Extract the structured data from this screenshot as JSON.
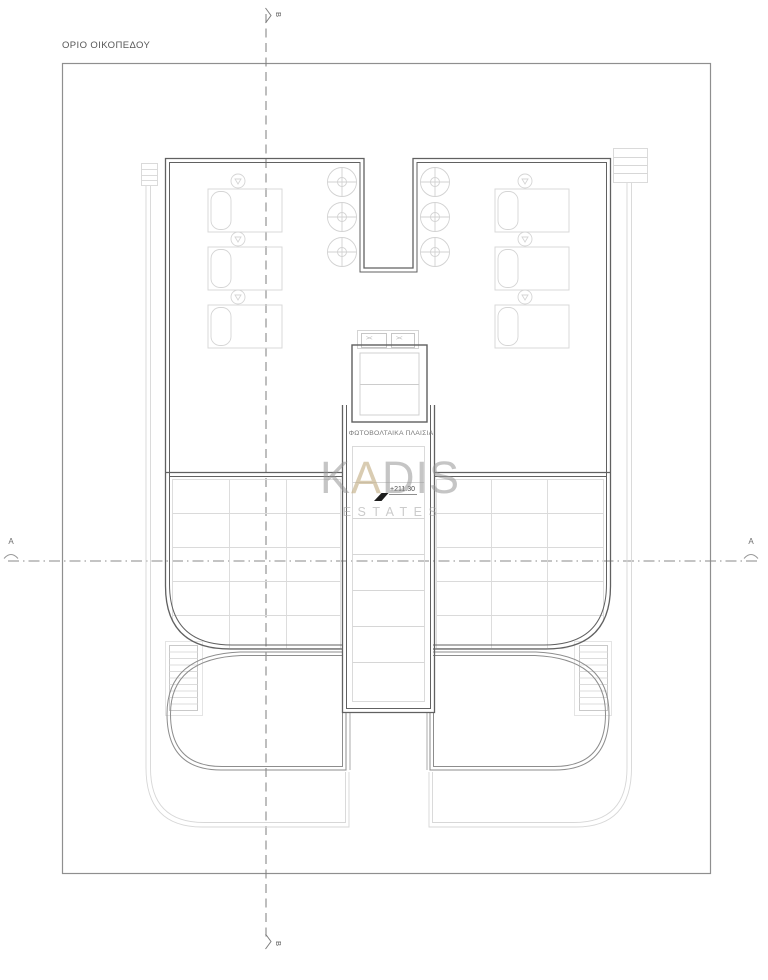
{
  "drawing": {
    "plot_boundary_label": "ΟΡΙΟ ΟΙΚΟΠΕΔΟΥ",
    "pv_panels_label": "ΦΩΤΟΒΟΛΤΑΙΚΑ ΠΛΑΙΣΙΑ",
    "elevation_marker": "+211.30",
    "section_vertical_label": "B",
    "section_horizontal_label": "A",
    "vent_symbol": "><"
  },
  "watermark": {
    "brand_k": "K",
    "brand_a": "A",
    "brand_dis": "DIS",
    "subtitle": "ESTATES"
  },
  "colors": {
    "background": "#ffffff",
    "plot_boundary": "#8f8f8f",
    "building_outline": "#616161",
    "secondary_outline": "#8d8d8d",
    "light_linework": "#d8d8d8",
    "watermark_gray": "#c6c6c6",
    "watermark_accent_beige": "#d3c5a8",
    "elevation_glyph": "#1d1d1d"
  }
}
